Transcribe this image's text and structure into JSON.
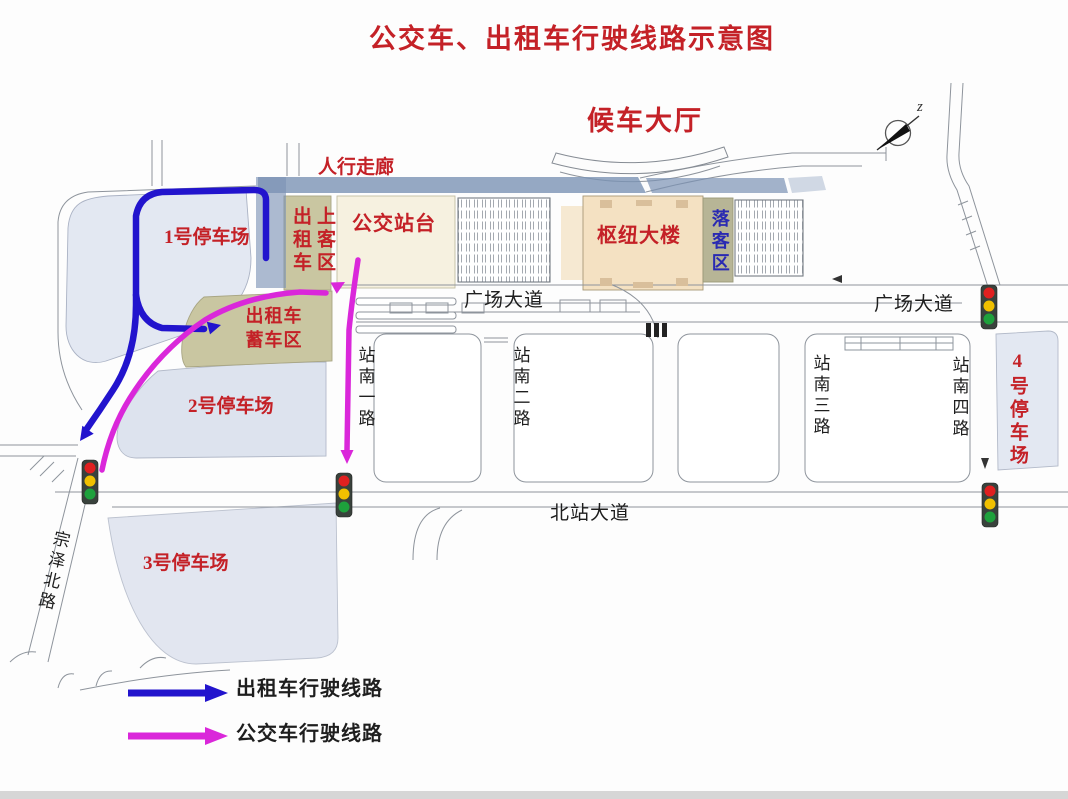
{
  "title": "公交车、出租车行驶线路示意图",
  "areas": {
    "waiting_hall": "候车大厅",
    "corridor": "人行走廊",
    "parking1": "1号停车场",
    "parking2": "2号停车场",
    "parking3": "3号停车场",
    "parking4": "4号停车场",
    "taxi_pickup": "出租车上客区",
    "taxi_staging": "出租车蓄车区",
    "bus_platform": "公交站台",
    "hub_building": "枢纽大楼",
    "dropoff": "落客区"
  },
  "roads": {
    "plaza_ave_left": "广场大道",
    "plaza_ave_right": "广场大道",
    "station_south_1": "站南一路",
    "station_south_2": "站南二路",
    "station_south_3": "站南三路",
    "station_south_4": "站南四路",
    "north_station_ave": "北站大道",
    "zongze_north_rd": "宗泽北路"
  },
  "legend": {
    "taxi_route": {
      "label": "出租车行驶线路",
      "color": "#2214cd"
    },
    "bus_route": {
      "label": "公交车行驶线路",
      "color": "#da27da"
    }
  },
  "compass": {
    "north_glyph": "z"
  },
  "colors": {
    "label_red": "#c42127",
    "label_blue": "#2a2ab2",
    "corridor_slate": "#7b92b4",
    "parking_fill": "#e3e8f2",
    "zone_khaki": "#c9c6a1",
    "platform_cream": "#f6f1e0",
    "hub_tan": "#f4e1c2",
    "dropoff_olive": "#b7b596",
    "traffic_red": "#e02020",
    "traffic_yellow": "#f0c000",
    "traffic_green": "#1ea13c"
  }
}
